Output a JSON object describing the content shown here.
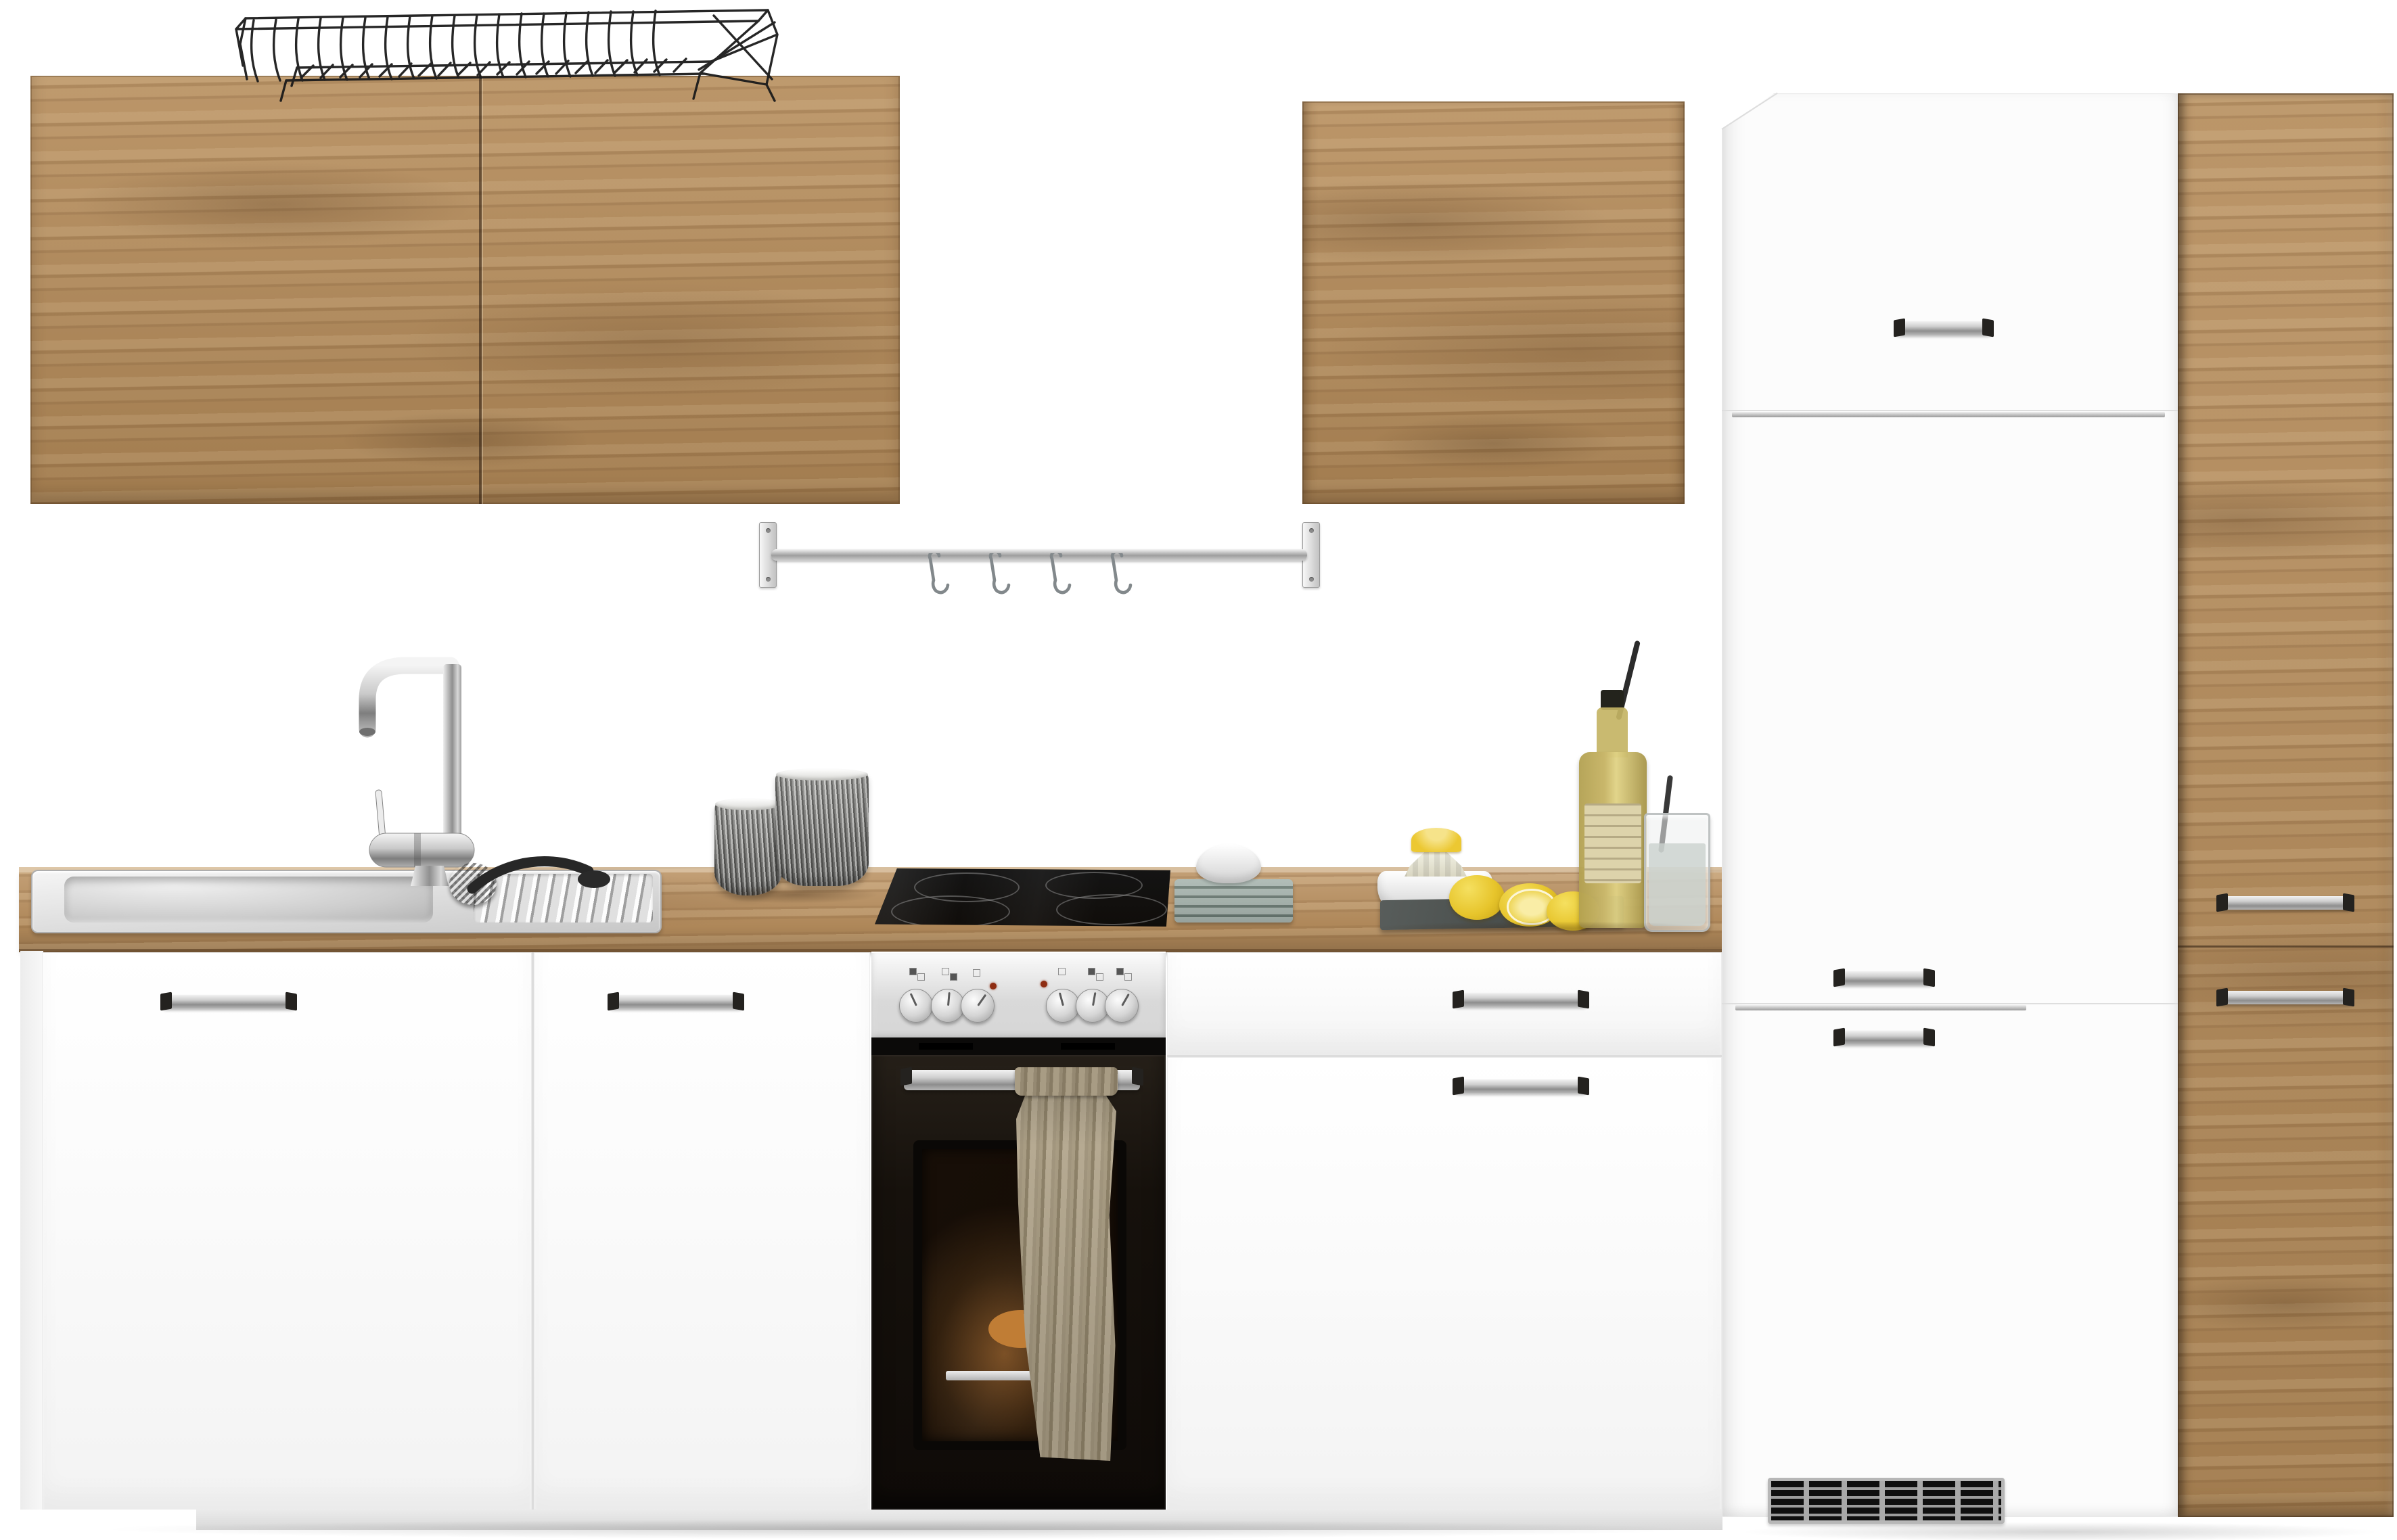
{
  "scene": {
    "type": "product-photo",
    "subject": "kitchen unit set with oak and white cabinets, built-in oven, sink and accessories on white background",
    "background": "#ffffff",
    "palette": {
      "wood": "#b48a58",
      "wood_dark": "#7a5734",
      "counter_wood": "#b98f5e",
      "cabinet_white": "#fbfbfb",
      "seam_gray": "#dcdcdc",
      "chrome_light": "#f2f2f2",
      "chrome_dark": "#8d8d8d",
      "appliance_black": "#100d0a",
      "steel_panel": "#d6d6d6",
      "towel": "#a89c83",
      "lemon": "#e7c52c",
      "slate": "#474c4a",
      "bottle": "#c9b76b",
      "indicator_red": "#8f2d12"
    },
    "labels": {
      "wall_cabinet_left": "left oak wall cabinet with two doors",
      "dish_rack": "black wire dish rack on wall cabinet",
      "utensil_rail": "chrome wall rail with four S-hooks",
      "wall_cabinet_right": "oak wall cabinet",
      "fridge_tall_unit": "white tall fridge housing unit with three doors and vent grille",
      "pantry_tall_unit": "tall oak pantry cabinet with two doors",
      "countertop": "oak worktop",
      "sink": "stainless steel inset sink with drainer",
      "faucet": "chrome mixer tap",
      "sink_brush": "black washing-up brush on drainer",
      "mugs": "two gray textured mugs",
      "cooktop": "black glass ceramic hob",
      "oven": "built-in oven with stainless control panel and six knobs",
      "oven_towel": "striped kitchen towel hanging on oven handle",
      "base_cabinet_1": "white base cabinet door",
      "base_cabinet_2": "white base cabinet door",
      "base_cabinet_right": "white base cabinet with drawer and door",
      "vent_grille": "ventilation grille",
      "napkins": "stacked gray napkins with small white bowl",
      "citrus_press": "white bowl with citrus press and lemon half",
      "lemons": "lemons on slate board",
      "slate_board": "dark slate serving board",
      "bottle": "bottle of lemonade with stirrer",
      "glass": "glass of lemonade with straw"
    }
  }
}
